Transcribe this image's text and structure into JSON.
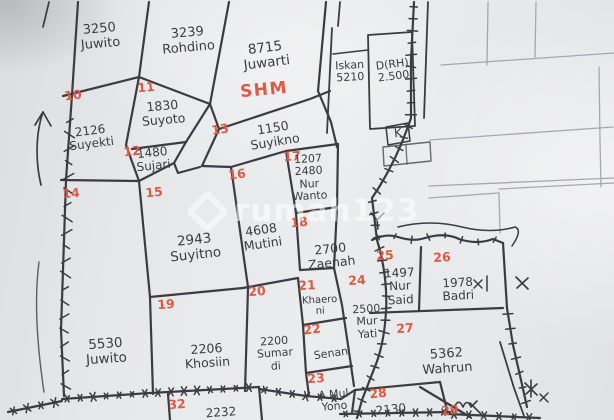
{
  "map_title": "hand-drawn land parcel sketch",
  "watermark": {
    "text": "rumah123",
    "logo": "diamond-house-icon"
  },
  "annotations": {
    "k_label": "K"
  },
  "colors": {
    "ink": "#3b3c42",
    "red": "#dd5a45",
    "paper": "#e7e8ea",
    "pencil": "#9b9ca3",
    "watermark": "rgba(255,255,255,0.55)"
  },
  "parcels": [
    {
      "id": "top-juwito",
      "num": null,
      "num_pos": null,
      "lines": [
        "3250",
        "Juwito"
      ],
      "label_pos": [
        100,
        37
      ],
      "size": 13,
      "rot": -5
    },
    {
      "id": "rohdino",
      "num": null,
      "num_pos": null,
      "lines": [
        "3239",
        "Rohdino"
      ],
      "label_pos": [
        188,
        41
      ],
      "size": 13,
      "rot": -5
    },
    {
      "id": "juwarti",
      "num": null,
      "num_pos": null,
      "lines": [
        "8715",
        "Juwarti"
      ],
      "label_pos": [
        266,
        56
      ],
      "size": 13.5,
      "rot": -7,
      "badge": "SHM",
      "badge_pos": [
        264,
        90
      ]
    },
    {
      "id": "iskan",
      "num": null,
      "num_pos": null,
      "lines": [
        "Iskan",
        "5210"
      ],
      "label_pos": [
        350,
        72
      ],
      "size": 11,
      "rot": -3
    },
    {
      "id": "drh",
      "num": null,
      "num_pos": null,
      "lines": [
        "D(RH)",
        "2.500"
      ],
      "label_pos": [
        393,
        71
      ],
      "size": 11,
      "rot": -7
    },
    {
      "id": "p10",
      "num": "10",
      "num_pos": [
        73,
        95
      ],
      "lines": [
        "2126",
        "Suyekti"
      ],
      "label_pos": [
        91,
        138
      ],
      "size": 12,
      "rot": -7
    },
    {
      "id": "p11",
      "num": "11",
      "num_pos": [
        146,
        87
      ],
      "lines": [
        "1830",
        "Suyoto"
      ],
      "label_pos": [
        163,
        113
      ],
      "size": 12.5,
      "rot": -5
    },
    {
      "id": "p12",
      "num": "12",
      "num_pos": [
        132,
        151
      ],
      "lines": [
        "1480",
        "Sujari"
      ],
      "label_pos": [
        153,
        160
      ],
      "size": 12,
      "rot": -6
    },
    {
      "id": "p13",
      "num": "13",
      "num_pos": [
        220,
        129
      ],
      "lines": [
        "1150",
        "Suyikno"
      ],
      "label_pos": [
        274,
        135
      ],
      "size": 12.5,
      "rot": -9
    },
    {
      "id": "p14",
      "num": "14",
      "num_pos": [
        71,
        193
      ],
      "lines": [
        "5530",
        "Juwito"
      ],
      "label_pos": [
        106,
        352
      ],
      "size": 13.5,
      "rot": -4
    },
    {
      "id": "p15",
      "num": "15",
      "num_pos": [
        154,
        192
      ],
      "lines": [
        "2943",
        "Suyitno"
      ],
      "label_pos": [
        195,
        248
      ],
      "size": 13.5,
      "rot": -6
    },
    {
      "id": "p16",
      "num": "16",
      "num_pos": [
        237,
        174
      ],
      "lines": [
        "4608",
        "Mutini"
      ],
      "label_pos": [
        262,
        237
      ],
      "size": 12.5,
      "rot": -8
    },
    {
      "id": "p17",
      "num": "17",
      "num_pos": [
        292,
        156
      ],
      "lines": [
        "1207",
        "2480",
        "Nur",
        "Wanto"
      ],
      "label_pos": [
        309,
        178
      ],
      "size": 11,
      "rot": -3
    },
    {
      "id": "p18",
      "num": "18",
      "num_pos": [
        299,
        222
      ],
      "lines": [
        "2700",
        "Zaenah"
      ],
      "label_pos": [
        331,
        256
      ],
      "size": 12.5,
      "rot": -6
    },
    {
      "id": "p19",
      "num": "19",
      "num_pos": [
        166,
        304
      ],
      "lines": [
        "2206",
        "Khosiin"
      ],
      "label_pos": [
        207,
        356
      ],
      "size": 12.5,
      "rot": -4
    },
    {
      "id": "p20",
      "num": "20",
      "num_pos": [
        257,
        291
      ],
      "lines": [
        "2200",
        "Sumar",
        "di"
      ],
      "label_pos": [
        275,
        354
      ],
      "size": 11,
      "rot": -4
    },
    {
      "id": "p21",
      "num": "21",
      "num_pos": [
        307,
        285
      ],
      "lines": [
        "Khaero",
        "ni"
      ],
      "label_pos": [
        320,
        306
      ],
      "size": 10,
      "rot": -3
    },
    {
      "id": "p22",
      "num": "22",
      "num_pos": [
        312,
        329
      ],
      "lines": [
        "Senan"
      ],
      "label_pos": [
        331,
        354
      ],
      "size": 11,
      "rot": -8
    },
    {
      "id": "p23",
      "num": "23",
      "num_pos": [
        316,
        378
      ],
      "lines": [
        "A.Mul",
        "Yono"
      ],
      "label_pos": [
        334,
        401
      ],
      "size": 11,
      "rot": -5
    },
    {
      "id": "p24",
      "num": "24",
      "num_pos": [
        357,
        280
      ],
      "lines": [
        "2500",
        "Mur",
        "Yati"
      ],
      "label_pos": [
        367,
        322
      ],
      "size": 11,
      "rot": -3
    },
    {
      "id": "p25",
      "num": "25",
      "num_pos": [
        385,
        255
      ],
      "lines": [
        "1497",
        "Nur",
        "Said"
      ],
      "label_pos": [
        400,
        287
      ],
      "size": 12,
      "rot": -3
    },
    {
      "id": "p26",
      "num": "26",
      "num_pos": [
        442,
        257
      ],
      "lines": [
        "1978",
        "Badri"
      ],
      "label_pos": [
        458,
        290
      ],
      "size": 12,
      "rot": -3
    },
    {
      "id": "p27",
      "num": "27",
      "num_pos": [
        405,
        328
      ],
      "lines": [
        "5362",
        "Wahrun"
      ],
      "label_pos": [
        447,
        362
      ],
      "size": 13,
      "rot": -4
    },
    {
      "id": "p28",
      "num": "28",
      "num_pos": [
        378,
        393
      ],
      "lines": [
        "2130"
      ],
      "label_pos": [
        391,
        410
      ],
      "size": 12,
      "rot": -6
    },
    {
      "id": "p29",
      "num": "29",
      "num_pos": [
        450,
        410
      ],
      "lines": [],
      "label_pos": null,
      "size": 12,
      "rot": -5
    },
    {
      "id": "p32",
      "num": "32",
      "num_pos": [
        177,
        404
      ],
      "lines": [
        "2232"
      ],
      "label_pos": [
        221,
        413
      ],
      "size": 12,
      "rot": -4
    }
  ]
}
